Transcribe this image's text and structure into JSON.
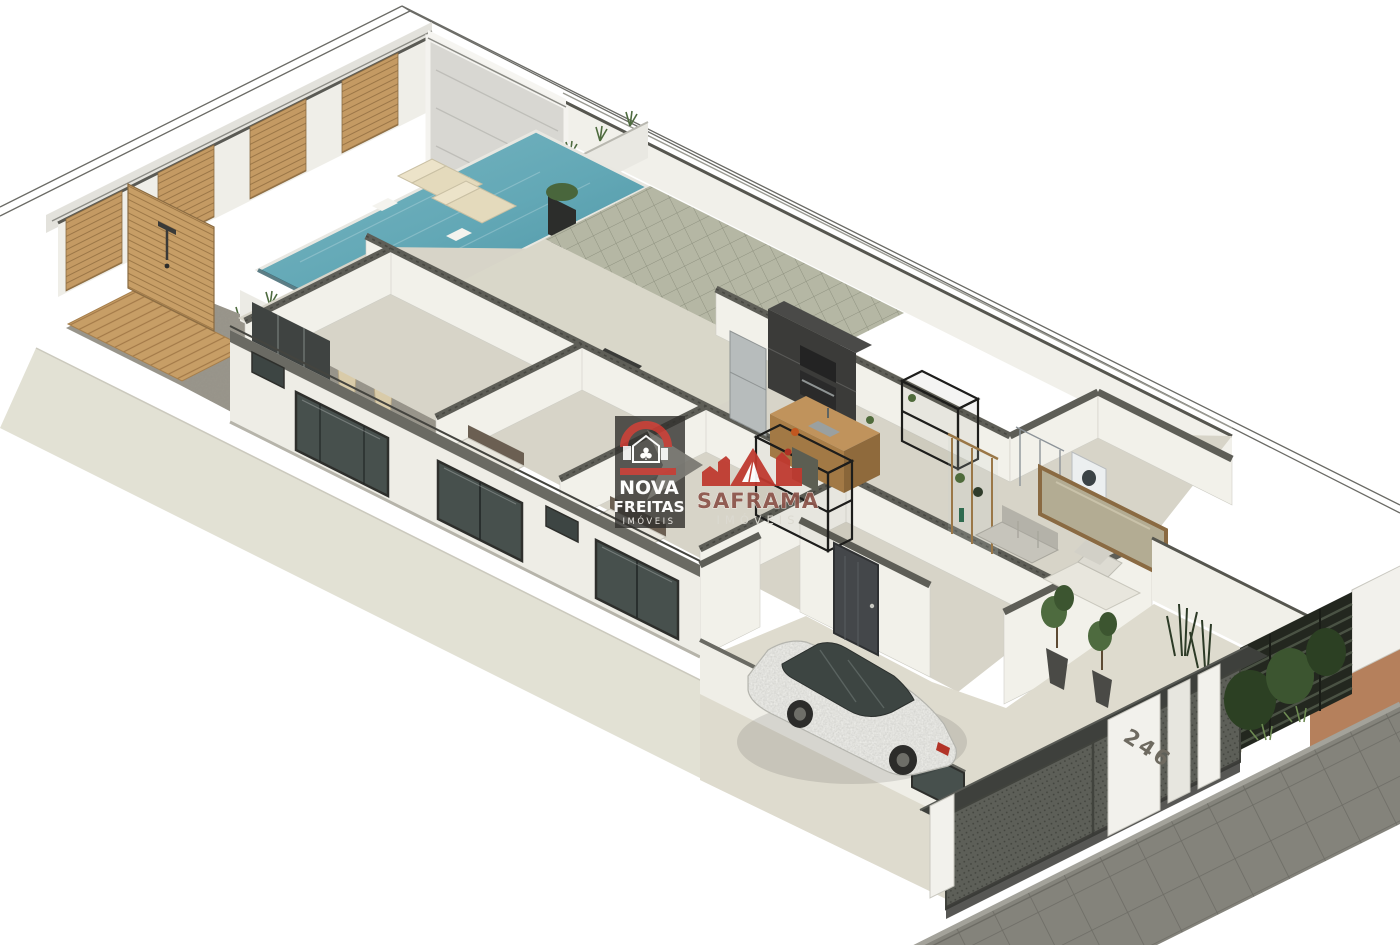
{
  "image": {
    "kind": "isometric 3D floor-plan render of a single-story house",
    "width": 1400,
    "height": 945
  },
  "watermarks": {
    "nova_freitas": {
      "line1": "NOVA",
      "line2": "FREITAS",
      "line3": "IMÓVEIS",
      "panel_color": "#31302d",
      "accent_red": "#bf3a32",
      "text_color": "#ffffff"
    },
    "saframa": {
      "name": "SAFRAMA",
      "subtitle": "IMÓVEIS",
      "accent_red": "#bf392f",
      "name_color": "#8d564c",
      "subtitle_color": "#dcdad1"
    }
  },
  "property": {
    "house_number": "246"
  },
  "palette": {
    "page_background": "#ffffff",
    "wall_white": "#efeee8",
    "wall_cut_top": "#5e5e57",
    "floor_beige": "#dedbce",
    "pool_water": "#63a8b6",
    "wood": "#c49a63",
    "greenery": "#4e6b3f",
    "sidewalk": "#84837b",
    "gate_metal": "#5d5f58",
    "terracotta": "#b5805c",
    "logo_red": "#bf3a32"
  },
  "scene_elements": [
    "lot-boundary",
    "perimeter-wall-wood-panels",
    "marble-feature-wall",
    "planter-grasses",
    "swimming-pool",
    "pool-loungers",
    "outdoor-shower-deck",
    "planter-vases",
    "bedrooms",
    "bathrooms",
    "kitchen-cabinets",
    "refrigerator",
    "kitchen-island-shelves",
    "glass-partition",
    "living-sofa",
    "wall-mirror",
    "suite-bed",
    "entry-door",
    "porch-plants",
    "driveway",
    "suv-car",
    "garage-gate",
    "gate-canopy",
    "house-number-pillar",
    "slat-fence",
    "front-garden",
    "sidewalk",
    "watermark-logos"
  ]
}
